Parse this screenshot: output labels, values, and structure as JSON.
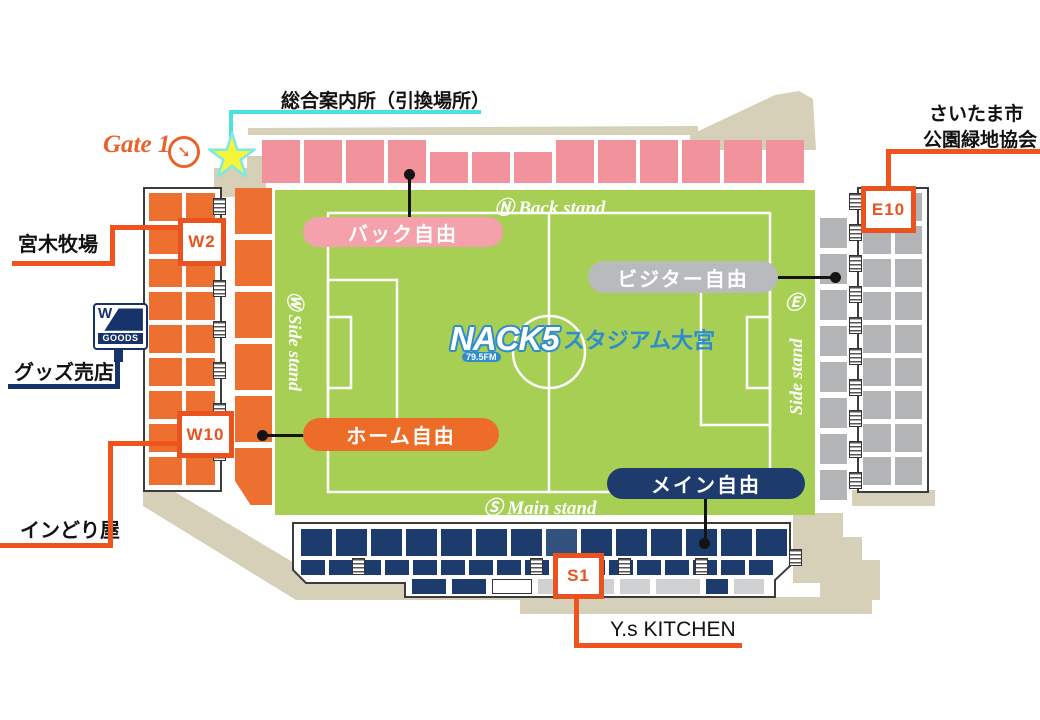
{
  "map": {
    "gate_label": "Gate 1",
    "info_office": "総合案内所（引換場所）",
    "saitama_line1": "さいたま市",
    "saitama_line2": "公園緑地協会",
    "miyaki": "宮木牧場",
    "goods_shop": "グッズ売店",
    "indoriya": "インどり屋",
    "ys_kitchen": "Y.s KITCHEN"
  },
  "goods_icon": {
    "letter": "W",
    "text": "GOODS"
  },
  "field": {
    "logo_nack": "NACK5",
    "logo_fm": "79.5FM",
    "logo_name": "スタジアム大宮",
    "north_label": "Ⓝ Back stand",
    "south_label": "Ⓢ Main stand",
    "west_label": "Ⓦ Side stand",
    "east_circle": "Ⓔ",
    "east_text": "Side stand"
  },
  "sections": {
    "back": {
      "label": "バック自由",
      "color": "#f4a1ab"
    },
    "visitor": {
      "label": "ビジター自由",
      "color": "#b9babd"
    },
    "home": {
      "label": "ホーム自由",
      "color": "#ed6d28"
    },
    "main": {
      "label": "メイン自由",
      "color": "#1d3c6d"
    }
  },
  "gate_boxes": {
    "w2": "W2",
    "w10": "W10",
    "e10": "E10",
    "s1": "S1"
  },
  "colors": {
    "field_green": "#a7cf54",
    "seat_pink": "#f1929d",
    "seat_orange": "#ed7031",
    "seat_gray": "#b2b4b6",
    "seat_navy": "#1d3c6d",
    "seat_navy_light": "#31517f",
    "row3_gray": "#cfd1d3",
    "concourse_beige": "#d6d0b8",
    "accent_orange": "#f0531c",
    "box_orange": "#e8531f",
    "cyan": "#4be0e4",
    "navy_line": "#17336b",
    "logo_blue": "#2f8ccd"
  },
  "seat_blocks": {
    "back_stand": {
      "pattern": [
        "tall",
        "tall",
        "tall",
        "tall",
        "short",
        "short",
        "short",
        "tall",
        "tall",
        "tall",
        "tall",
        "tall",
        "tall"
      ]
    },
    "west_stand": {
      "outer_rows": 9,
      "outer_cols": 2,
      "front_blocks": 6,
      "stairs": 7
    },
    "east_stand": {
      "outer_rows": 9,
      "outer_cols": 2,
      "front_blocks": 8,
      "stairs": 10
    },
    "main_stand": {
      "row1_blocks": 14,
      "row1_light_index": 7,
      "row2_blocks": 17,
      "row2_stairs": 4,
      "row3": [
        {
          "color": "navy",
          "w": 34
        },
        {
          "color": "navy",
          "w": 34
        },
        {
          "color": "white",
          "w": 40
        },
        {
          "color": "gray",
          "w": 36
        },
        {
          "color": "gray",
          "w": 34
        },
        {
          "color": "gray",
          "w": 30
        },
        {
          "color": "gray",
          "w": 44
        },
        {
          "color": "navy",
          "w": 22
        },
        {
          "color": "gray",
          "w": 30
        }
      ]
    }
  }
}
